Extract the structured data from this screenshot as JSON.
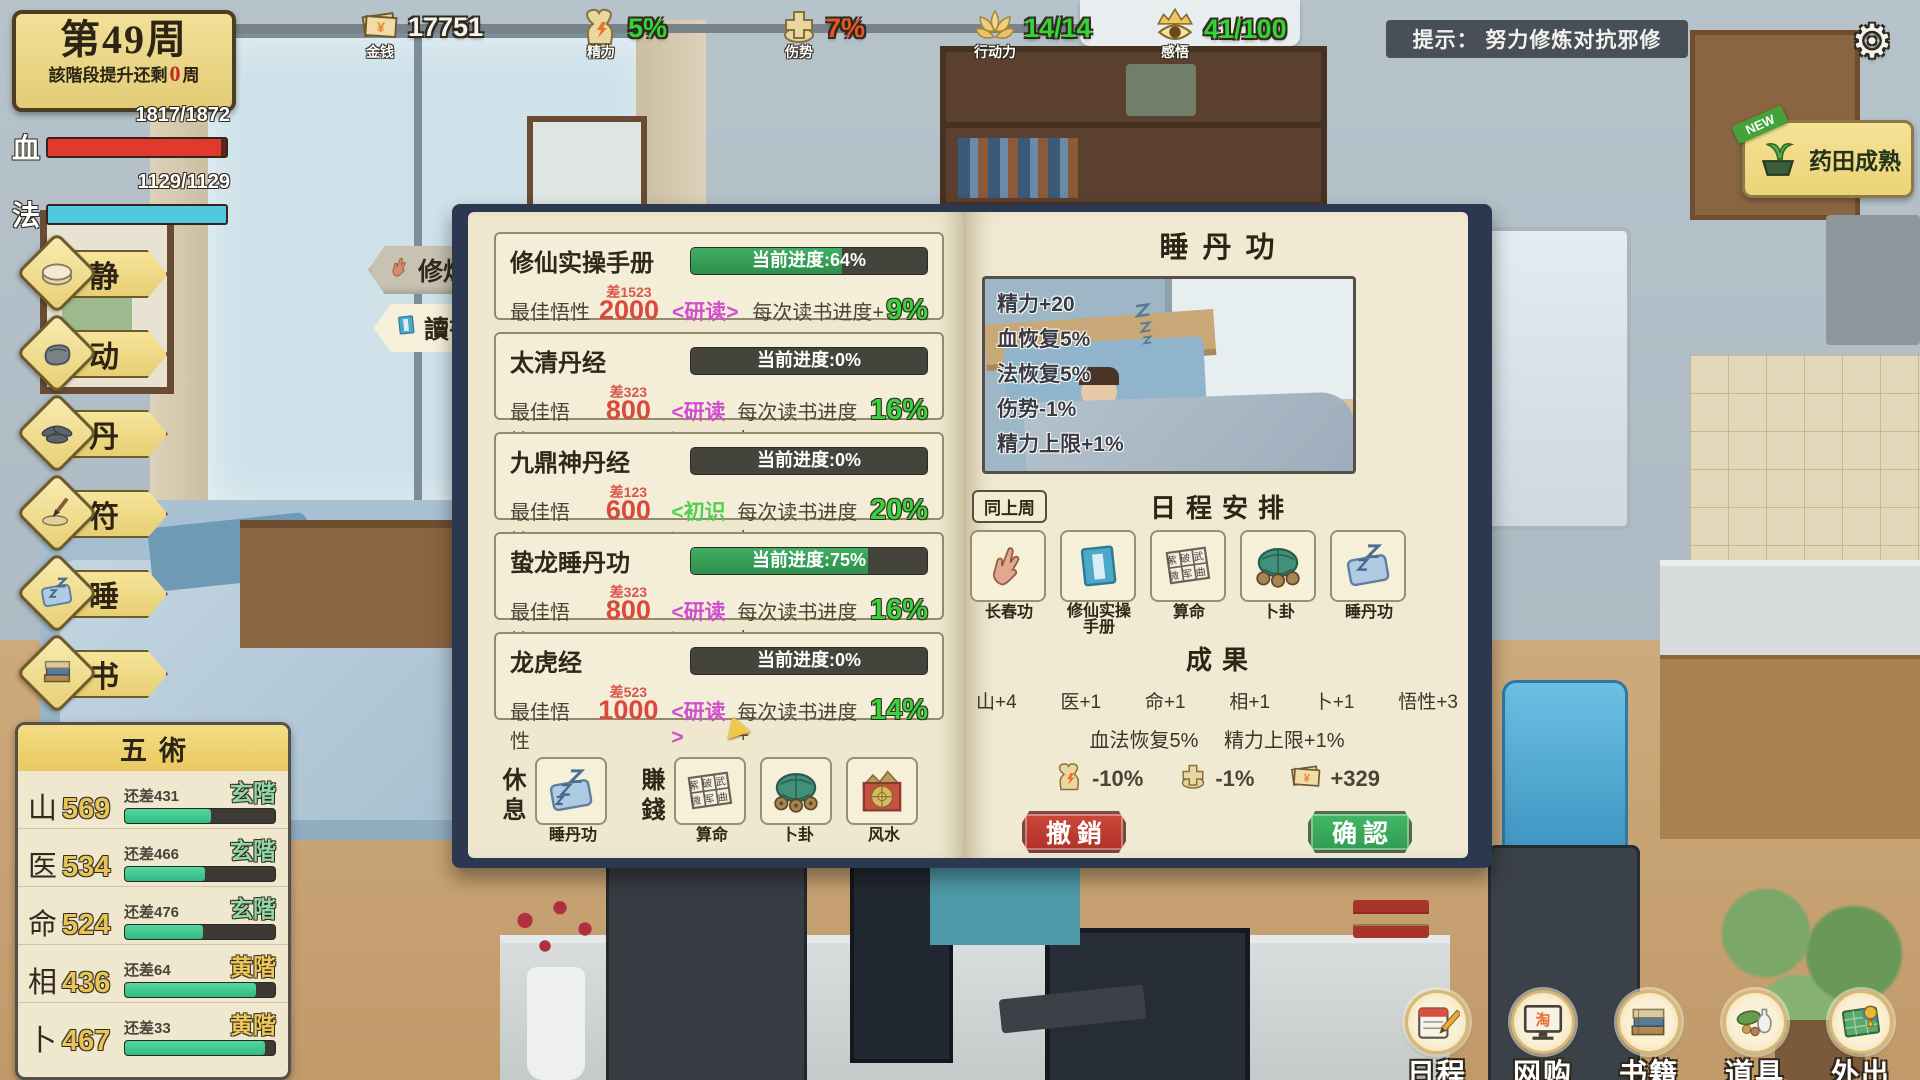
{
  "week": {
    "title": "第49周",
    "remain_pre": "該階段提升还剩",
    "remain_num": "0",
    "remain_post": "周"
  },
  "topbar": {
    "money": {
      "label": "金钱",
      "value": "17751",
      "color": "#f2f2ee"
    },
    "energy": {
      "label": "精力",
      "value": "5%",
      "color": "#35d435"
    },
    "injury": {
      "label": "伤势",
      "value": "7%",
      "color": "#e85426"
    },
    "action": {
      "label": "行动力",
      "value": "14/14",
      "color": "#35d435"
    },
    "insight": {
      "label": "感悟",
      "value": "41/100",
      "color": "#35d435"
    },
    "tip": "提示： 努力修炼对抗邪修"
  },
  "vitals": {
    "hp_label": "血",
    "hp_value": "1817/1872",
    "hp_pct": 97,
    "hp_color": "#df3a2d",
    "mp_label": "法",
    "mp_value": "1129/1129",
    "mp_pct": 100,
    "mp_color": "#52c8dc"
  },
  "side_menu": {
    "items": [
      {
        "label": "静"
      },
      {
        "label": "动"
      },
      {
        "label": "丹"
      },
      {
        "label": "符"
      },
      {
        "label": "睡"
      },
      {
        "label": "书"
      }
    ]
  },
  "farm_alert": {
    "badge": "NEW",
    "label": "药田成熟"
  },
  "five_arts": {
    "title": "五術",
    "rows": [
      {
        "name": "山",
        "value": "569",
        "diff": "还差431",
        "rank": "玄階",
        "rank_color": "#8fd8a8",
        "pct": 57
      },
      {
        "name": "医",
        "value": "534",
        "diff": "还差466",
        "rank": "玄階",
        "rank_color": "#8fd8a8",
        "pct": 53
      },
      {
        "name": "命",
        "value": "524",
        "diff": "还差476",
        "rank": "玄階",
        "rank_color": "#8fd8a8",
        "pct": 52
      },
      {
        "name": "相",
        "value": "436",
        "diff": "还差64",
        "rank": "黄階",
        "rank_color": "#eec95a",
        "pct": 87
      },
      {
        "name": "卜",
        "value": "467",
        "diff": "还差33",
        "rank": "黄階",
        "rank_color": "#eec95a",
        "pct": 93
      }
    ]
  },
  "tabs": {
    "cultivate": "修煉",
    "read": "讀書"
  },
  "labels": {
    "aptitude": "最佳悟性",
    "gain_prefix": "每次读书进度+"
  },
  "books": [
    {
      "name": "修仙实操手册",
      "progress": "当前进度:64%",
      "pct": 64,
      "diff": "差1523",
      "aptitude": "2000",
      "mode": "<研读>",
      "mode_color": "#cf4fcf",
      "gain": "9%"
    },
    {
      "name": "太清丹经",
      "progress": "当前进度:0%",
      "pct": 0,
      "diff": "差323",
      "aptitude": "800",
      "mode": "<研读>",
      "mode_color": "#cf4fcf",
      "gain": "16%"
    },
    {
      "name": "九鼎神丹经",
      "progress": "当前进度:0%",
      "pct": 0,
      "diff": "差123",
      "aptitude": "600",
      "mode": "<初识>",
      "mode_color": "#4fcf4f",
      "gain": "20%"
    },
    {
      "name": "蛰龙睡丹功",
      "progress": "当前进度:75%",
      "pct": 75,
      "diff": "差323",
      "aptitude": "800",
      "mode": "<研读>",
      "mode_color": "#cf4fcf",
      "gain": "16%"
    },
    {
      "name": "龙虎经",
      "progress": "当前进度:0%",
      "pct": 0,
      "diff": "差523",
      "aptitude": "1000",
      "mode": "<研读>",
      "mode_color": "#cf4fcf",
      "gain": "14%"
    }
  ],
  "left_actions": {
    "rest_label": "休息",
    "earn_label": "賺錢",
    "cards": [
      {
        "label": "睡丹功"
      },
      {
        "label": "算命"
      },
      {
        "label": "卜卦"
      },
      {
        "label": "风水"
      }
    ]
  },
  "fortune": {
    "row1": "紫破武",
    "row2": "微军曲"
  },
  "detail": {
    "title": "睡丹功",
    "effects": [
      "精力+20",
      "血恢复5%",
      "法恢复5%",
      "伤势-1%",
      "精力上限+1%"
    ]
  },
  "schedule": {
    "same_btn": "同上周",
    "title": "日程安排",
    "slots": [
      {
        "label": "长春功"
      },
      {
        "label": "修仙实操手册"
      },
      {
        "label": "算命"
      },
      {
        "label": "卜卦"
      },
      {
        "label": "睡丹功"
      }
    ]
  },
  "results": {
    "title": "成果",
    "stats": [
      "山+4",
      "医+1",
      "命+1",
      "相+1",
      "卜+1",
      "悟性+3"
    ],
    "recovery": "血法恢复5%",
    "limit": "精力上限+1%",
    "costs": [
      {
        "value": "-10%"
      },
      {
        "value": "-1%"
      },
      {
        "value": "+329"
      }
    ]
  },
  "actions": {
    "undo": "撤銷",
    "confirm": "确認"
  },
  "nav": {
    "shop_char": "淘",
    "items": [
      {
        "label": "日程"
      },
      {
        "label": "网购"
      },
      {
        "label": "书籍"
      },
      {
        "label": "道具"
      },
      {
        "label": "外出"
      }
    ]
  },
  "icons": {
    "gear": "⚙",
    "yen": "¥"
  }
}
